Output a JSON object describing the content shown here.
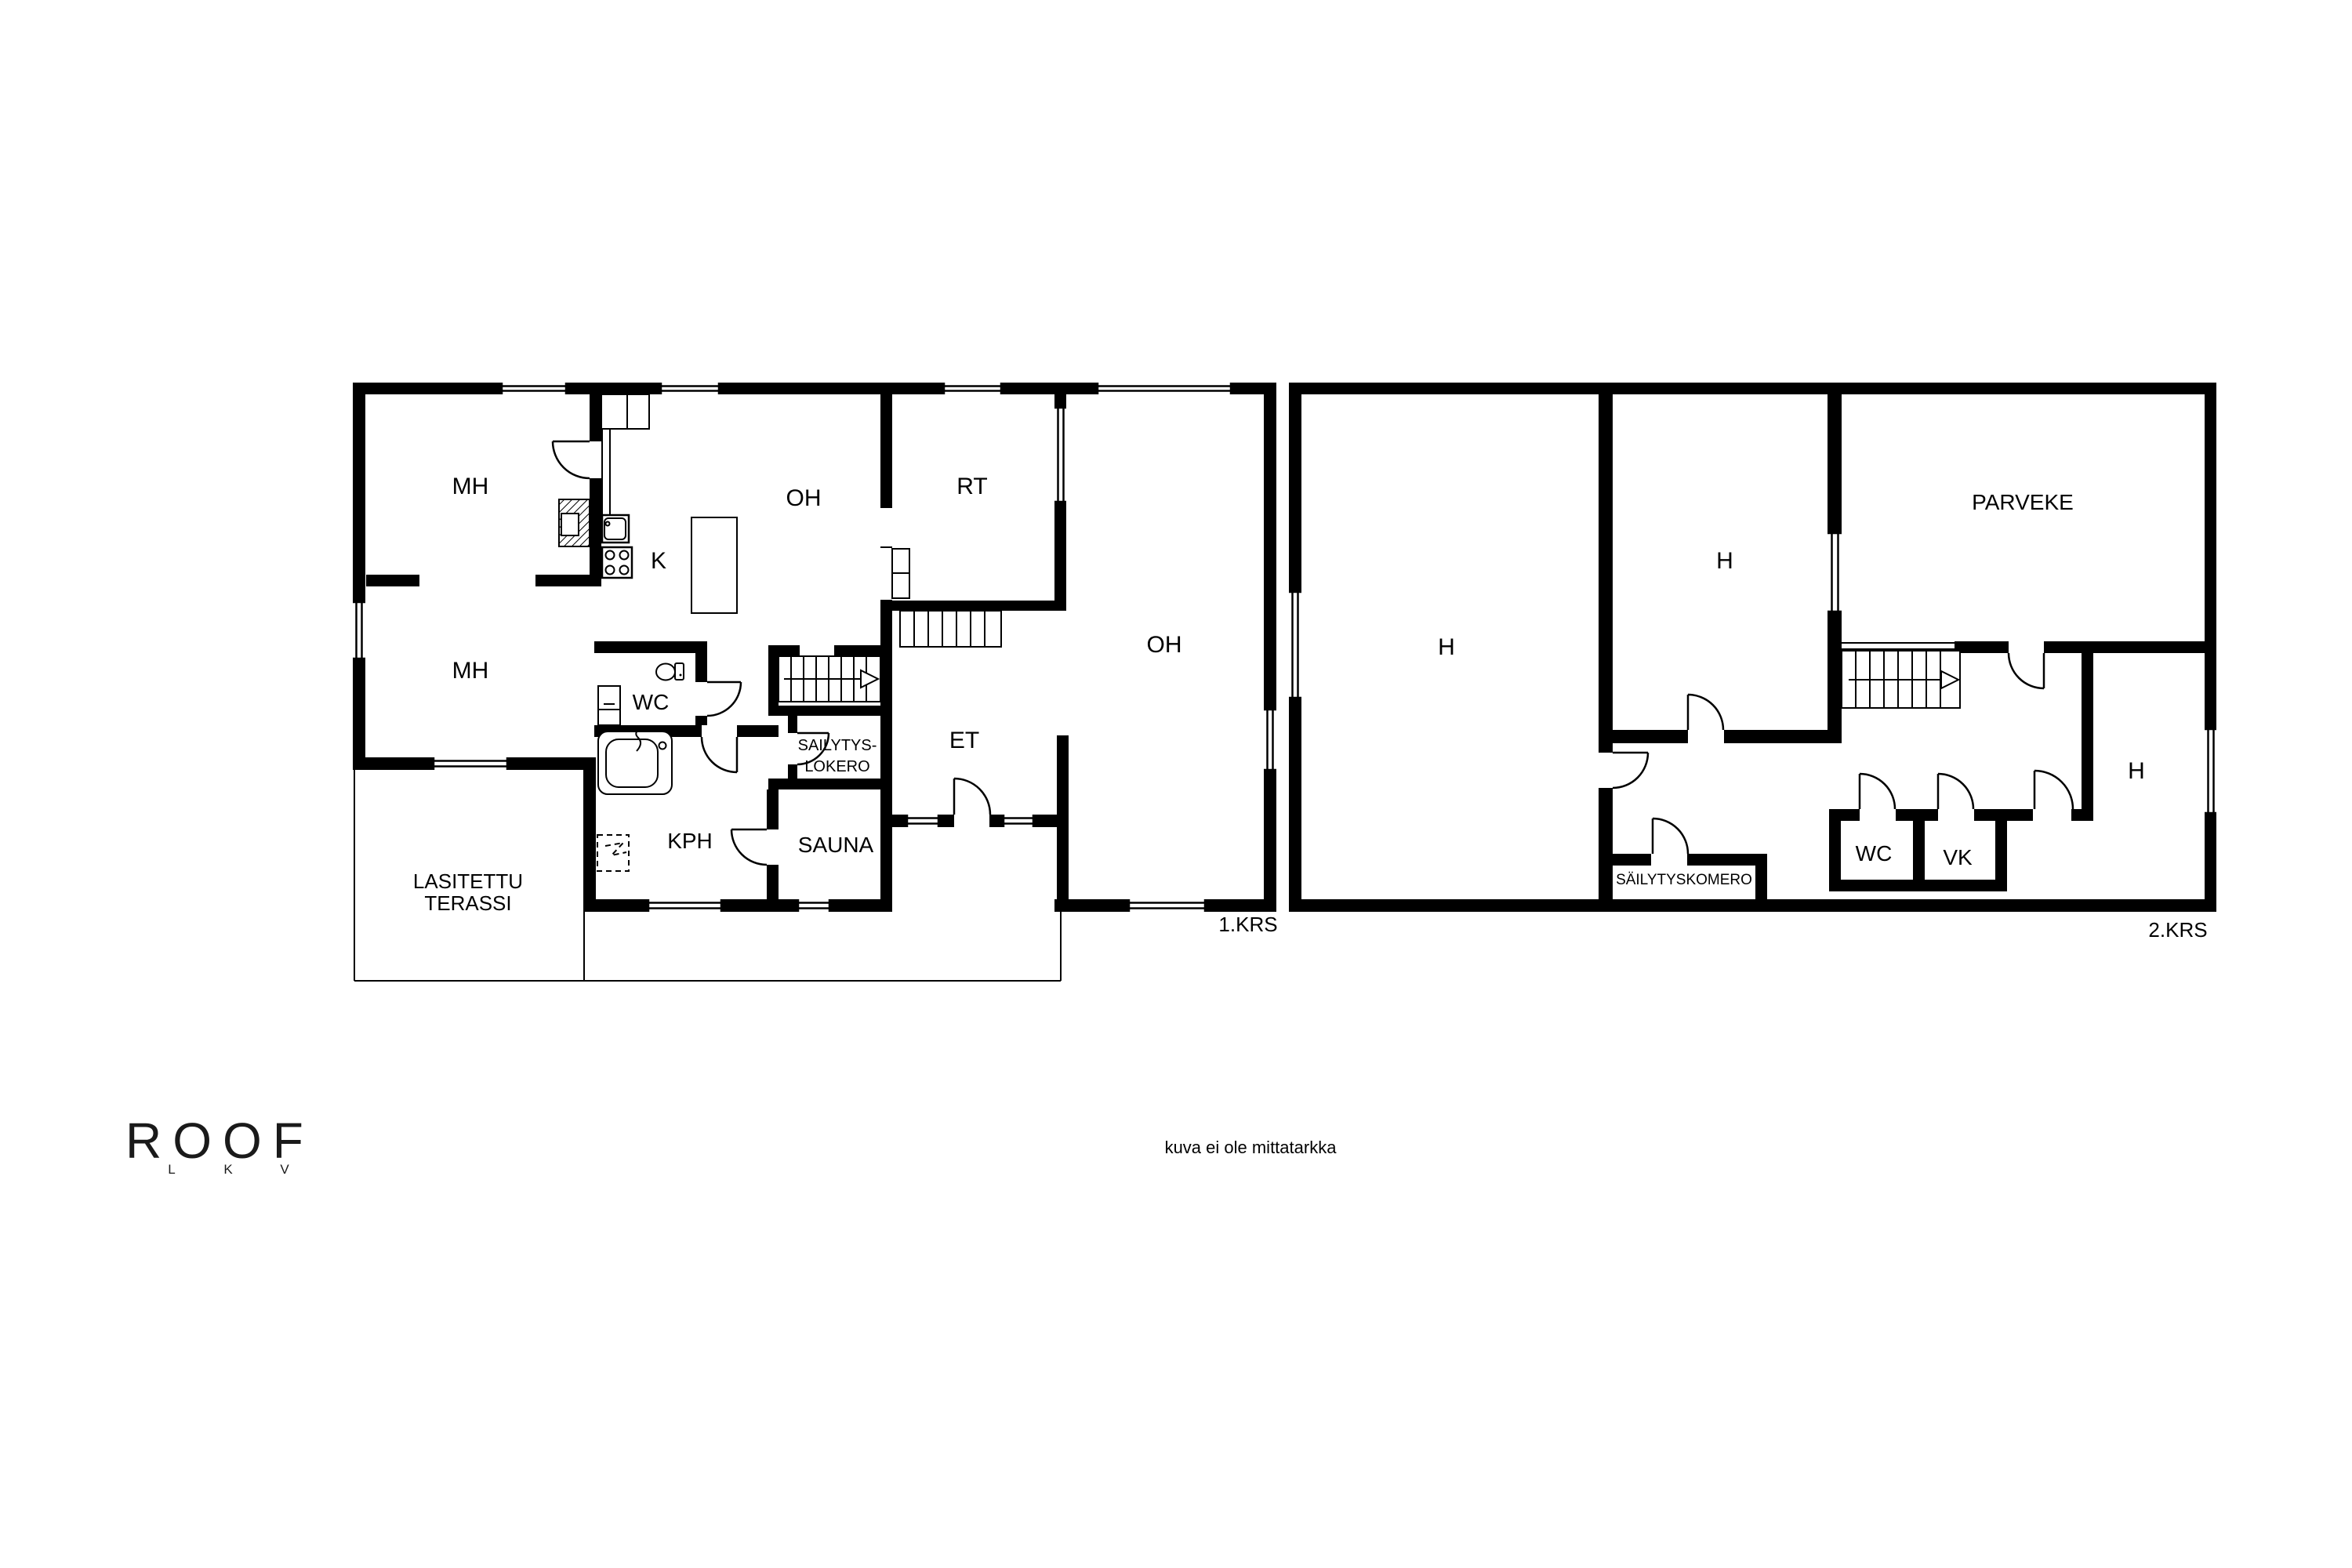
{
  "colors": {
    "background": "#ffffff",
    "walls": "#000000",
    "text": "#000000"
  },
  "floor1": {
    "name": "1.KRS",
    "rooms": {
      "mh1": "MH",
      "mh2": "MH",
      "k": "K",
      "oh1": "OH",
      "rt": "RT",
      "oh2": "OH",
      "wc": "WC",
      "sailytys_line1": "SAILYTYS-",
      "sailytys_line2": "LOKERO",
      "et": "ET",
      "kph": "KPH",
      "sauna": "SAUNA",
      "terassi_line1": "LASITETTU",
      "terassi_line2": "TERASSI"
    }
  },
  "floor2": {
    "name": "2.KRS",
    "rooms": {
      "h_large": "H",
      "h_middle": "H",
      "h_right": "H",
      "parveke": "PARVEKE",
      "sailytyskomero": "SÄILYTYSKOMERO",
      "wc": "WC",
      "vk": "VK"
    }
  },
  "branding": {
    "logo": "ROOF",
    "logo_letters": [
      "L",
      "K",
      "V"
    ],
    "disclaimer": "kuva ei ole mittatarkka"
  }
}
